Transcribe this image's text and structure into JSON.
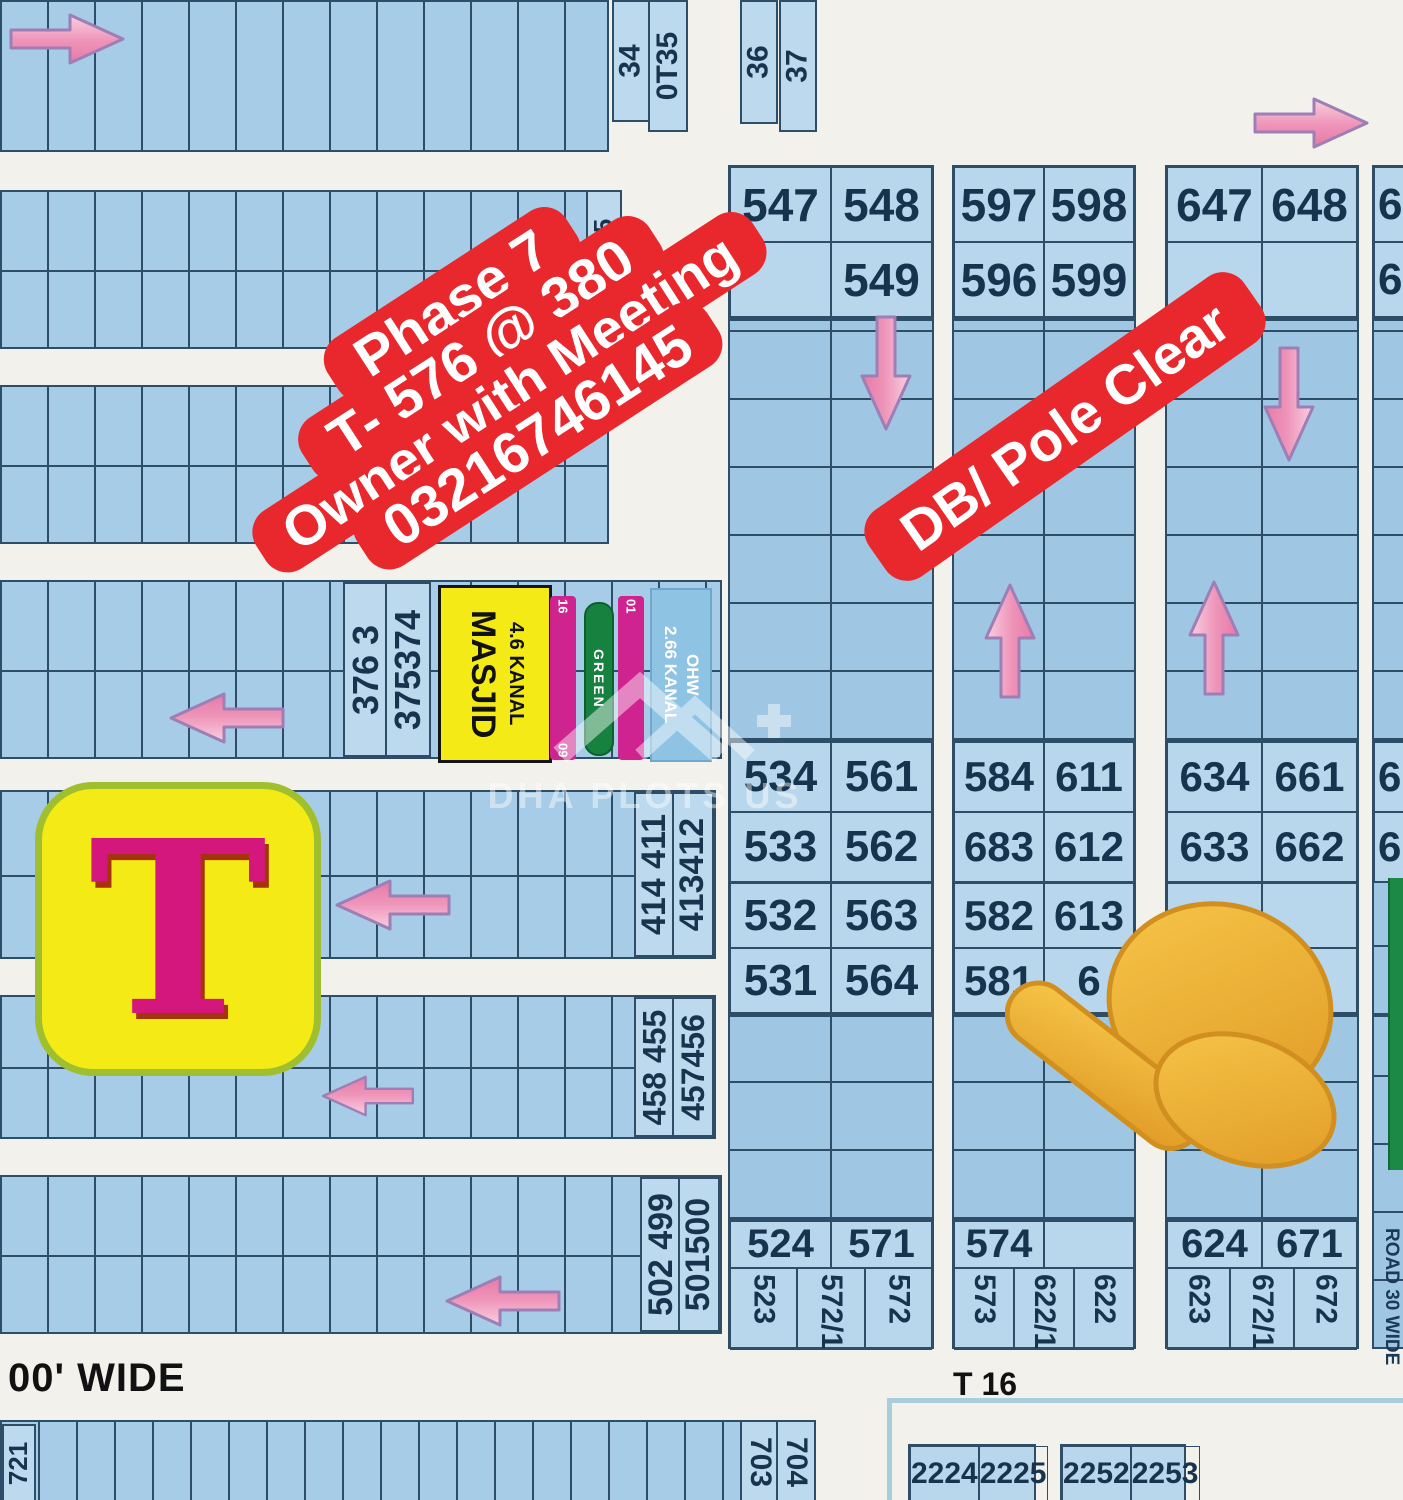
{
  "colors": {
    "banner_red": "#e8282c",
    "plot_blue": "#a6cce7",
    "cell_blue": "#b9d7ec",
    "grid": "#2e4d66",
    "arrow_pink": "#ee93b8",
    "hand_yellow": "#f2b52e",
    "masjid_yellow": "#f3ea16",
    "bar_magenta": "#cf2390",
    "bar_green": "#17813f",
    "tlogo_magenta": "#d4177c"
  },
  "banner": {
    "line1": "Phase 7",
    "line2": "T- 576 @ 380",
    "line3": "Owner with Meeting",
    "line4": "03216746145"
  },
  "pole_banner": {
    "label": "DB/ Pole Clear"
  },
  "top_labels": {
    "a": "34",
    "b": "0T35",
    "c": "36",
    "d": "37"
  },
  "strip_labels": {
    "b1": "475",
    "c1": "338 3",
    "c2": "337336",
    "d1": "376 3",
    "d2": "375374",
    "e1": "414 411",
    "e2": "413412",
    "f1": "458 455",
    "f2": "457456",
    "g1": "502 499",
    "g2": "501500"
  },
  "masjid": {
    "name": "MASJID",
    "area": "4.6 KANAL"
  },
  "bars": {
    "left_top": "16",
    "left_bottom": "09",
    "green": "GREEN",
    "right_top": "01"
  },
  "ohw": {
    "area": "2.66 KANAL",
    "name": "OHW"
  },
  "t_logo": "T",
  "headers": {
    "a": [
      "547",
      "548",
      "",
      "549"
    ],
    "b": [
      "597",
      "598",
      "596",
      "599"
    ],
    "c": [
      "647",
      "648",
      "",
      ""
    ],
    "d": [
      "6",
      "6"
    ]
  },
  "mid_upper": {
    "a": [
      "534",
      "561",
      "533",
      "562"
    ],
    "b": [
      "584",
      "611",
      "683",
      "612"
    ],
    "c": [
      "634",
      "661",
      "633",
      "662"
    ],
    "d": [
      "6",
      "6"
    ]
  },
  "mid_lower": {
    "a": [
      "532",
      "563",
      "531",
      "564"
    ],
    "b": [
      "582",
      "613",
      "581",
      "6"
    ],
    "c": [
      "",
      "",
      "",
      ""
    ]
  },
  "bottom_blocks": {
    "a": {
      "top": [
        "524",
        "571"
      ],
      "rot": [
        "523",
        "572/1",
        "572"
      ]
    },
    "b": {
      "top": [
        "574",
        ""
      ],
      "rot": [
        "573",
        "622/1",
        "622"
      ]
    },
    "c": {
      "top": [
        "624",
        "671"
      ],
      "rot": [
        "623",
        "672/1",
        "672"
      ]
    }
  },
  "roads": {
    "wide": "00' WIDE",
    "t16": "T 16",
    "road30": "ROAD 30 WIDE"
  },
  "bottom_strip": {
    "left": "721",
    "col1": "703",
    "col2": "704",
    "blk1": [
      "2224",
      "2225"
    ],
    "blk2": [
      "2252",
      "2253"
    ]
  },
  "watermark": "DHA PLOTS US"
}
